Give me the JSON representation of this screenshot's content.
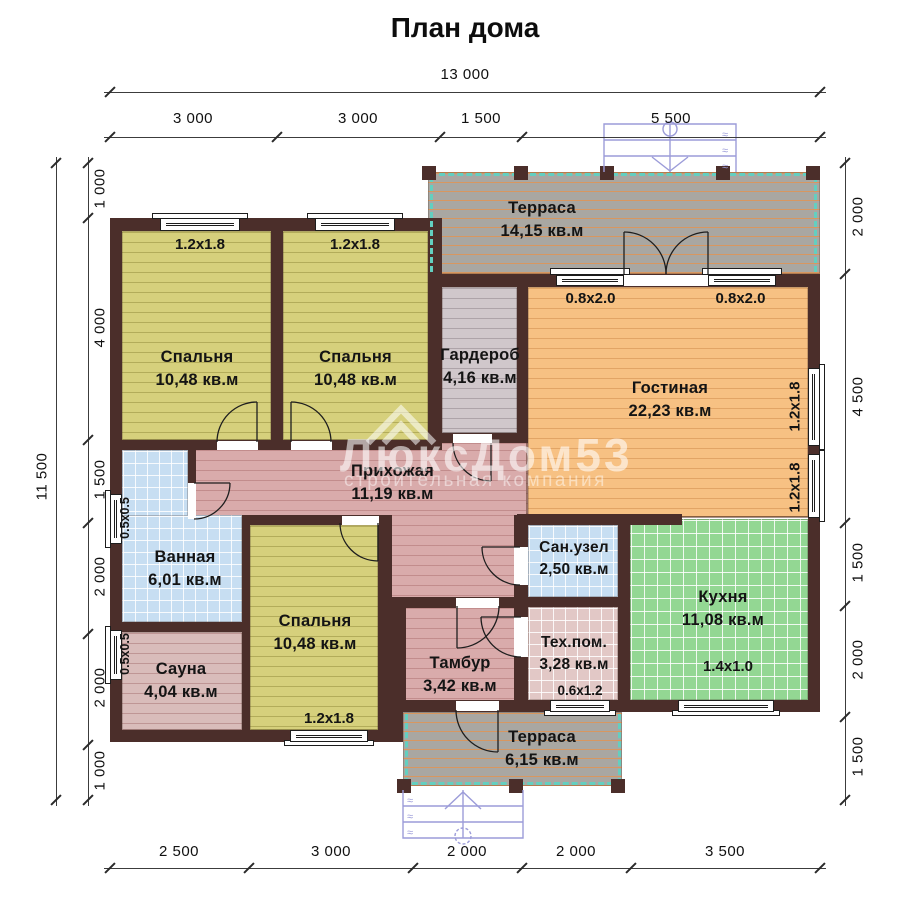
{
  "title": "План дома",
  "watermark": {
    "brand": "ЛюксДом53",
    "subtitle": "строительная компания"
  },
  "dimensions": {
    "top_total": "13 000",
    "top_segments": [
      "3 000",
      "3 000",
      "1 500",
      "5 500"
    ],
    "bottom_segments": [
      "2 500",
      "3 000",
      "2 000",
      "2 000",
      "3 500"
    ],
    "left_total": "11 500",
    "left_segments": [
      "1 000",
      "4 000",
      "1 500",
      "2 000",
      "2 000",
      "1 000"
    ],
    "right_segments": [
      "2 000",
      "4 500",
      "1 500",
      "2 000",
      "1 500"
    ]
  },
  "rooms": {
    "terrace_top": {
      "name": "Терраса",
      "area": "14,15 кв.м"
    },
    "bedroom1": {
      "name": "Спальня",
      "area": "10,48 кв.м"
    },
    "bedroom2": {
      "name": "Спальня",
      "area": "10,48 кв.м"
    },
    "wardrobe": {
      "name": "Гардероб",
      "area": "4,16 кв.м"
    },
    "living": {
      "name": "Гостиная",
      "area": "22,23 кв.м"
    },
    "hallway": {
      "name": "Прихожая",
      "area": "11,19 кв.м"
    },
    "bathroom": {
      "name": "Ванная",
      "area": "6,01 кв.м"
    },
    "sauna": {
      "name": "Сауна",
      "area": "4,04 кв.м"
    },
    "bedroom3": {
      "name": "Спальня",
      "area": "10,48 кв.м"
    },
    "tambour": {
      "name": "Тамбур",
      "area": "3,42 кв.м"
    },
    "wc": {
      "name": "Сан.узел",
      "area": "2,50 кв.м"
    },
    "tech": {
      "name": "Тех.пом.",
      "area": "3,28 кв.м"
    },
    "kitchen": {
      "name": "Кухня",
      "area": "11,08 кв.м"
    },
    "terrace_bottom": {
      "name": "Терраса",
      "area": "6,15 кв.м"
    }
  },
  "windows": {
    "bedroom1": "1.2x1.8",
    "bedroom2": "1.2x1.8",
    "living_top_left": "0.8x2.0",
    "living_top_right": "0.8x2.0",
    "living_side_upper": "1.2x1.8",
    "living_side_lower": "1.2x1.8",
    "bathroom": "0.5x0.5",
    "sauna": "0.5x0.5",
    "bedroom3": "1.2x1.8",
    "tech": "0.6x1.2",
    "kitchen": "1.4x1.0"
  },
  "colors": {
    "wall": "#4b2e2a",
    "bedroom_floor": "#d6d07c",
    "living_floor": "#f7c183",
    "hallway_floor": "#d9abab",
    "sauna_floor": "#d9bcba",
    "wardrobe_floor": "#d0c7cb",
    "terrace_floor": "#a9a7a2",
    "bathroom_tile": "#c7def2",
    "kitchen_tile": "#93d793",
    "tech_tile": "#e2c8c6",
    "terrace_dash": "#63cfc0",
    "stairs": "#9c9cd9",
    "watermark": "#ffffff"
  }
}
